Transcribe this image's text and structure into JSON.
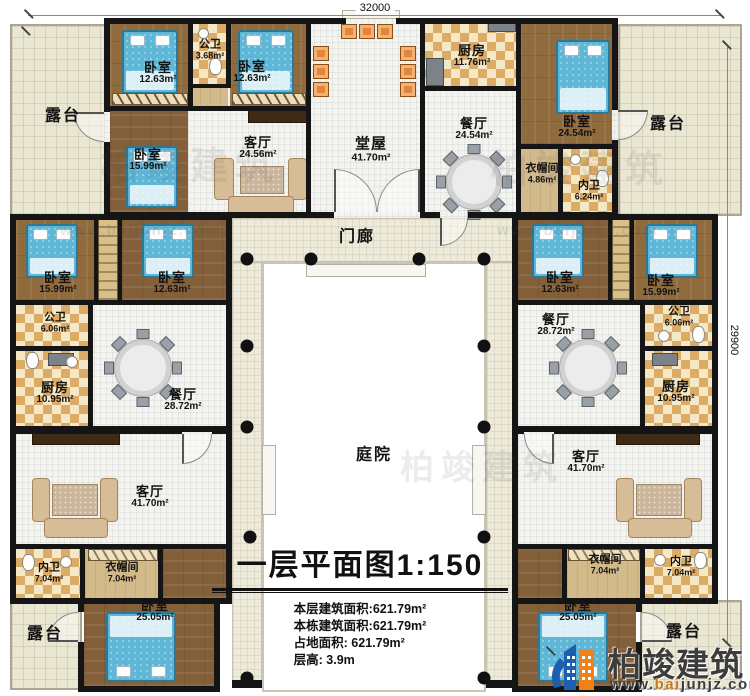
{
  "dimensions": {
    "top": "32000",
    "right": "29900"
  },
  "rooms": [
    {
      "name": "露台",
      "area": ""
    },
    {
      "name": "卧室",
      "area": "12.63m²"
    },
    {
      "name": "公卫",
      "area": "3.68m²"
    },
    {
      "name": "卧室",
      "area": "12.63m²"
    },
    {
      "name": "卧室",
      "area": "15.99m²"
    },
    {
      "name": "客厅",
      "area": "24.56m²"
    },
    {
      "name": "堂屋",
      "area": "41.70m²"
    },
    {
      "name": "厨房",
      "area": "11.76m²"
    },
    {
      "name": "餐厅",
      "area": "24.54m²"
    },
    {
      "name": "卧室",
      "area": "24.54m²"
    },
    {
      "name": "露台",
      "area": ""
    },
    {
      "name": "衣帽间",
      "area": "4.86m²"
    },
    {
      "name": "内卫",
      "area": "6.24m²"
    },
    {
      "name": "门廊",
      "area": ""
    },
    {
      "name": "卧室",
      "area": "15.99m²"
    },
    {
      "name": "卧室",
      "area": "12.63m²"
    },
    {
      "name": "公卫",
      "area": "6.06m²"
    },
    {
      "name": "厨房",
      "area": "10.95m²"
    },
    {
      "name": "餐厅",
      "area": "28.72m²"
    },
    {
      "name": "卧室",
      "area": "12.63m²"
    },
    {
      "name": "卧室",
      "area": "15.99m²"
    },
    {
      "name": "餐厅",
      "area": "28.72m²"
    },
    {
      "name": "公卫",
      "area": "6.06m²"
    },
    {
      "name": "厨房",
      "area": "10.95m²"
    },
    {
      "name": "庭院",
      "area": ""
    },
    {
      "name": "客厅",
      "area": "41.70m²"
    },
    {
      "name": "内卫",
      "area": "7.04m²"
    },
    {
      "name": "衣帽间",
      "area": "7.04m²"
    },
    {
      "name": "卧室",
      "area": "25.05m²"
    },
    {
      "name": "露台",
      "area": ""
    },
    {
      "name": "客厅",
      "area": "41.70m²"
    },
    {
      "name": "衣帽间",
      "area": "7.04m²"
    },
    {
      "name": "内卫",
      "area": "7.04m²"
    },
    {
      "name": "卧室",
      "area": "25.05m²"
    },
    {
      "name": "露台",
      "area": ""
    }
  ],
  "title_block": {
    "title": "一层平面图",
    "scale": "1:150",
    "stats": [
      "本层建筑面积:621.79m²",
      "本栋建筑面积:621.79m²",
      "占地面积: 621.79m²",
      "层高: 3.9m"
    ]
  },
  "logo": {
    "name": "柏竣建筑",
    "url_prefix": "www.",
    "url_mid": "bai",
    "url_suffix": "junjz.com"
  },
  "watermark": {
    "text": "柏竣建筑",
    "url": "www.baijunjz.com"
  },
  "colors": {
    "wall": "#151515",
    "wood": "#8f6b3e",
    "bed": "#5fb7d7",
    "logo_blue": "#1d5fae",
    "logo_orange": "#f08119"
  }
}
